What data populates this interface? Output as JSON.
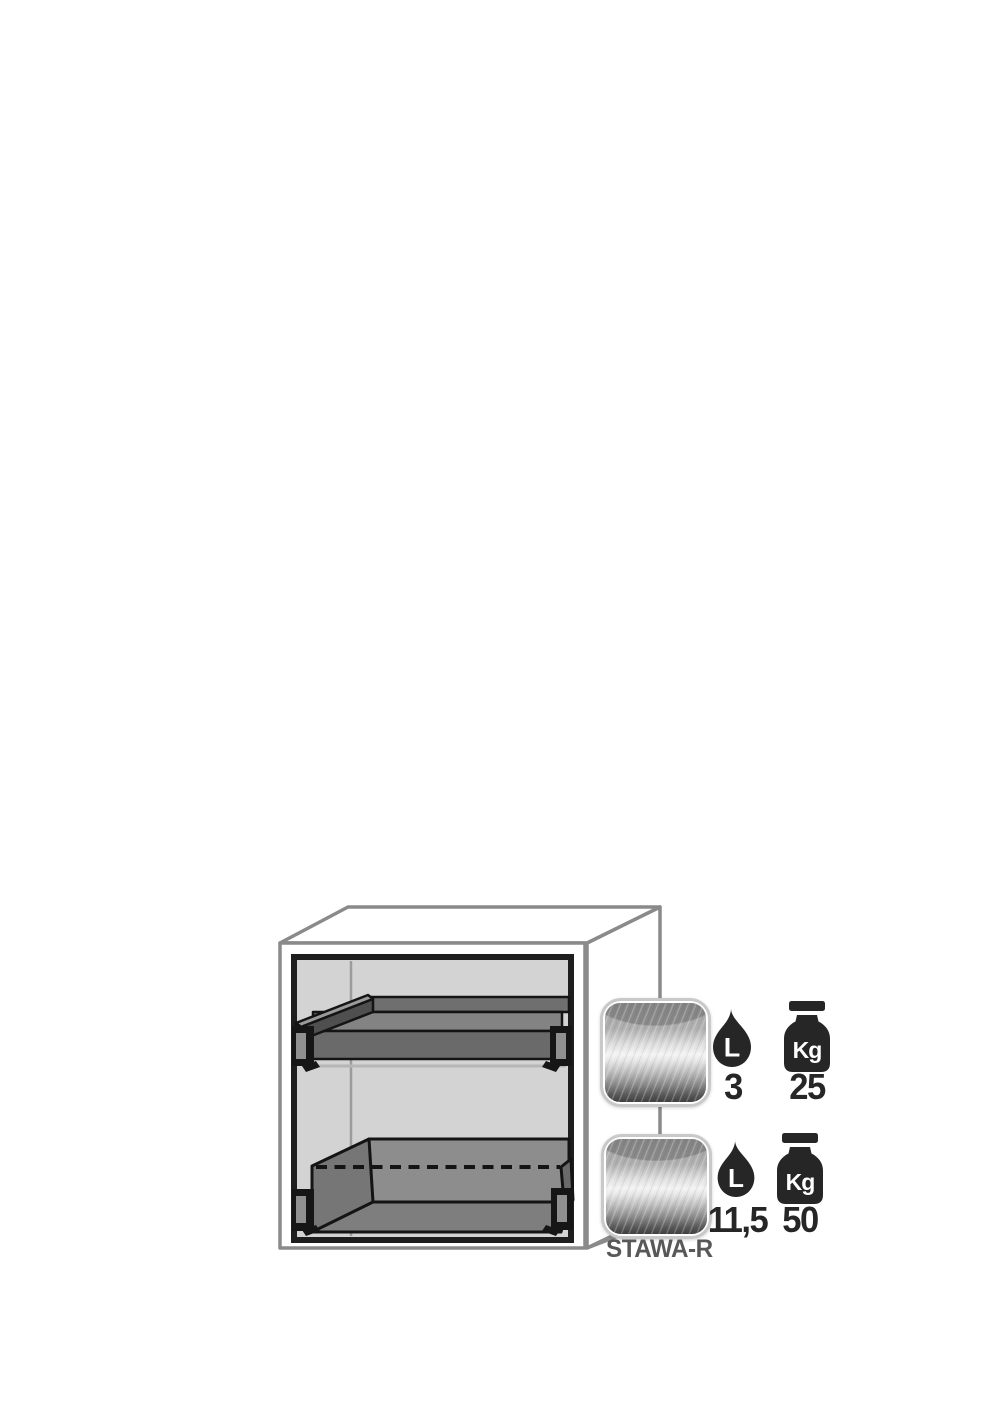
{
  "diagram": {
    "model_label": "STAWA-R"
  },
  "colors": {
    "ink": "#262626",
    "outline_gray": "#8a8a8a",
    "label_gray": "#58585a",
    "interior_gray": "#d3d3d3",
    "tray_gray": "#6a6a6a"
  },
  "levels": [
    {
      "id": "pull-out-shelf",
      "volume_icon": "droplet-icon",
      "volume_unit": "L",
      "volume_value": "3",
      "load_icon": "weight-icon",
      "load_unit": "Kg",
      "load_value": "25"
    },
    {
      "id": "bottom-sump-tray",
      "volume_icon": "droplet-icon",
      "volume_unit": "L",
      "volume_value": "11,5",
      "load_icon": "weight-icon",
      "load_unit": "Kg",
      "load_value": "50"
    }
  ]
}
